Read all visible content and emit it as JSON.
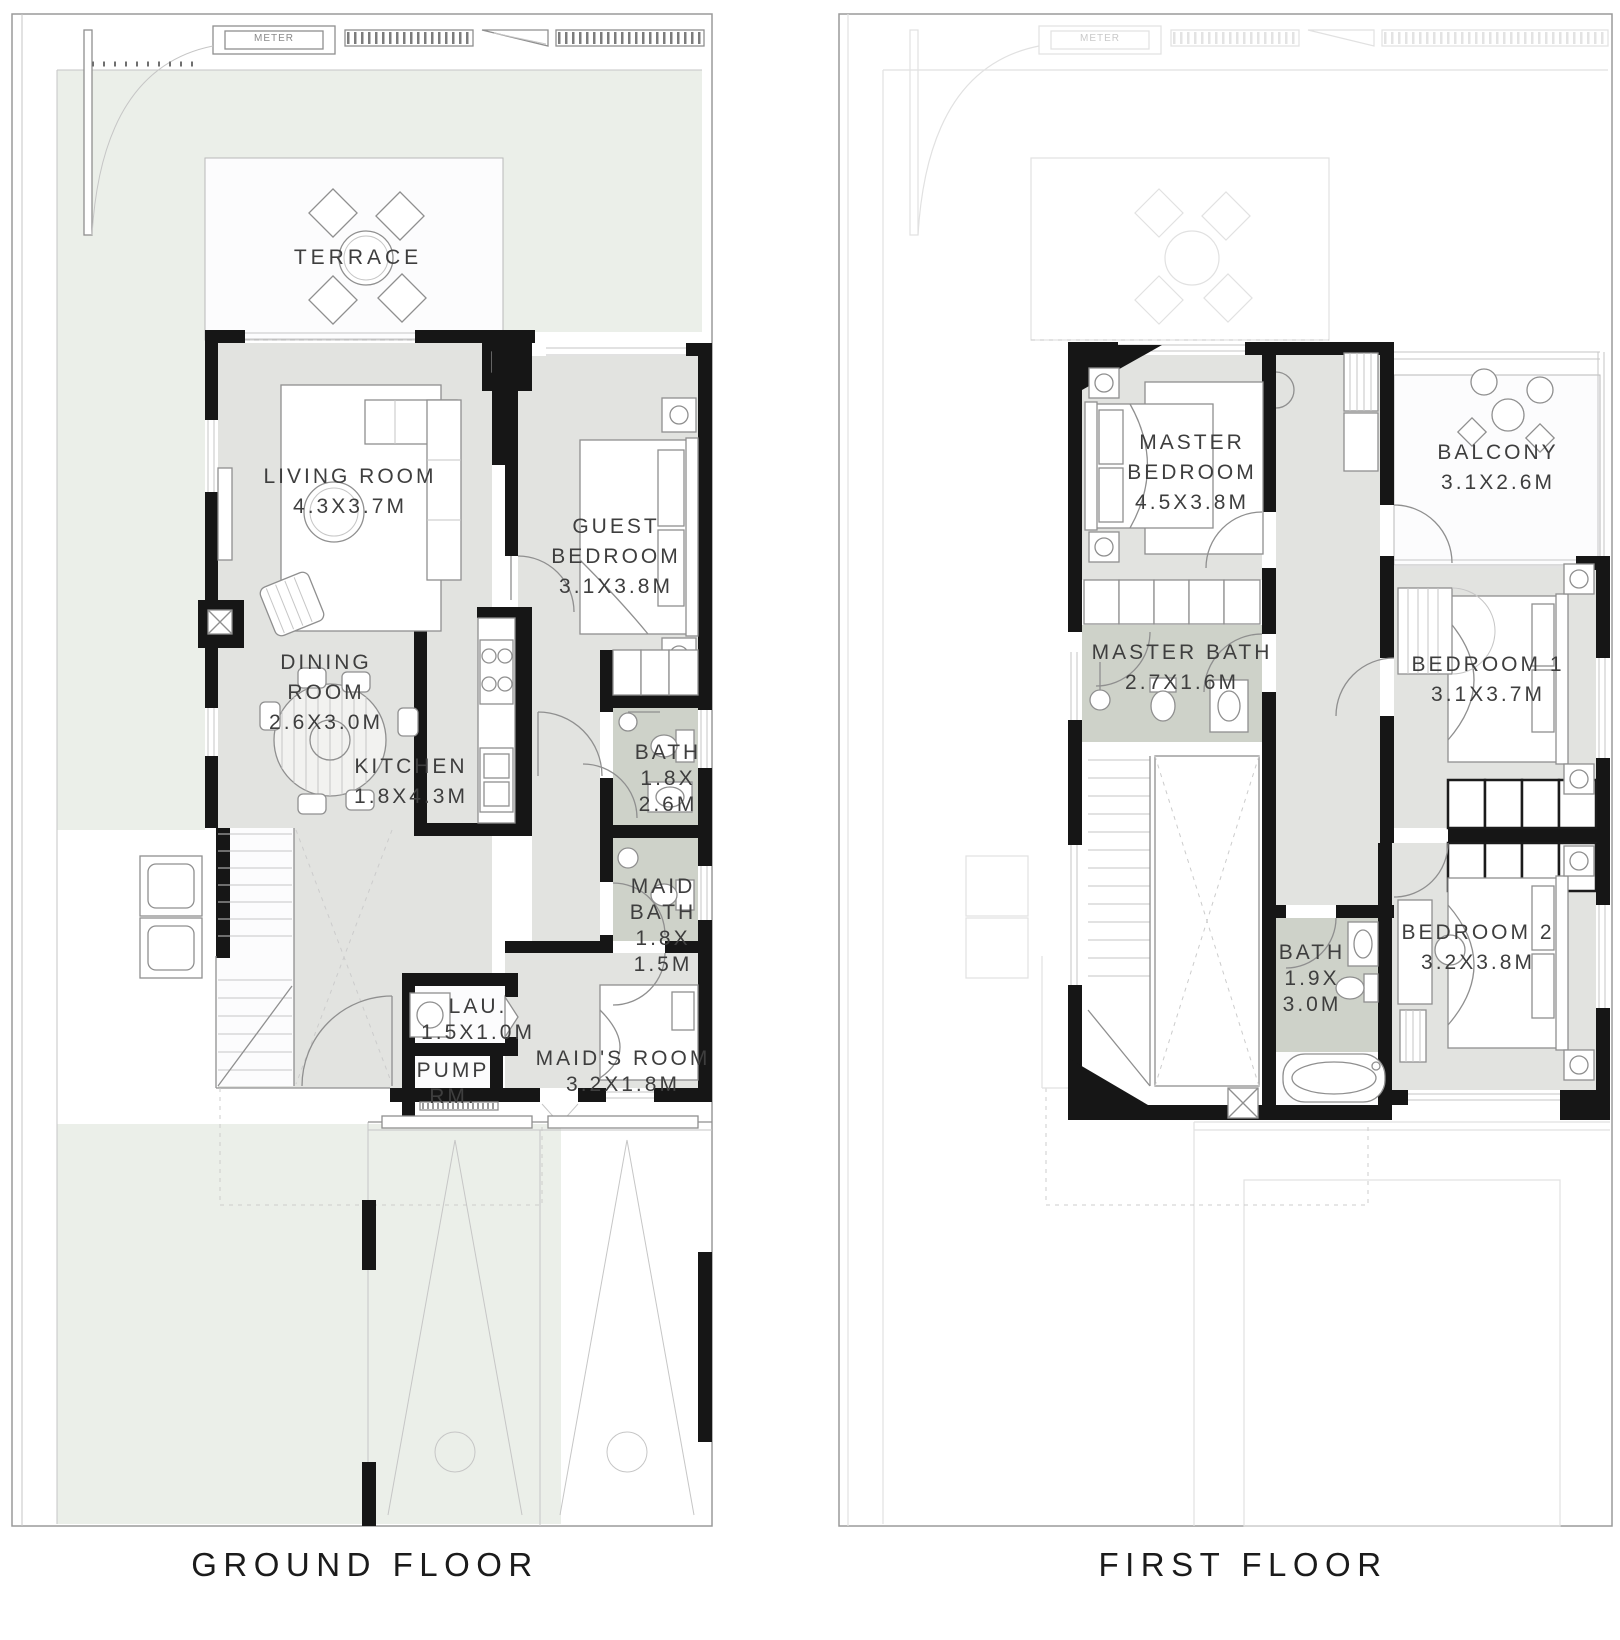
{
  "drawing": {
    "type": "residential floor plan",
    "sheets": 2
  },
  "colors": {
    "wall": "#161616",
    "room_floor": "#e2e3e0",
    "bath_floor": "#ced2c9",
    "lawn": "#ebefe9",
    "terrace_floor": "#fcfcfd",
    "line": "#8f8f8f",
    "label_text": "#3e3e3e",
    "caption_text": "#1b1b1b"
  },
  "ground_floor": {
    "caption": "GROUND FLOOR",
    "meter_label": "METER",
    "rooms": {
      "terrace": {
        "name": "TERRACE"
      },
      "living_room": {
        "name": "LIVING ROOM",
        "size": "4.3X3.7M"
      },
      "guest_bedroom": {
        "name_1": "GUEST",
        "name_2": "BEDROOM",
        "size": "3.1X3.8M"
      },
      "dining_room": {
        "name_1": "DINING",
        "name_2": "ROOM",
        "size": "2.6X3.0M"
      },
      "kitchen": {
        "name": "KITCHEN",
        "size": "1.8X4.3M"
      },
      "bath": {
        "name": "BATH",
        "size_1": "1.8X",
        "size_2": "2.6M"
      },
      "maid_bath": {
        "name_1": "MAID",
        "name_2": "BATH",
        "size_1": "1.8X",
        "size_2": "1.5M"
      },
      "laundry": {
        "name": "LAU.",
        "size": "1.5X1.0M"
      },
      "pump_room": {
        "name_1": "PUMP",
        "name_2": "RM."
      },
      "maids_room": {
        "name": "MAID'S ROOM",
        "size": "3.2X1.8M"
      }
    }
  },
  "first_floor": {
    "caption": "FIRST FLOOR",
    "meter_label": "METER",
    "rooms": {
      "master_bedroom": {
        "name_1": "MASTER",
        "name_2": "BEDROOM",
        "size": "4.5X3.8M"
      },
      "balcony": {
        "name": "BALCONY",
        "size": "3.1X2.6M"
      },
      "master_bath": {
        "name": "MASTER BATH",
        "size": "2.7X1.6M"
      },
      "bedroom_1": {
        "name": "BEDROOM 1",
        "size": "3.1X3.7M"
      },
      "bath": {
        "name": "BATH",
        "size_1": "1.9X",
        "size_2": "3.0M"
      },
      "bedroom_2": {
        "name": "BEDROOM 2",
        "size": "3.2X3.8M"
      }
    }
  }
}
